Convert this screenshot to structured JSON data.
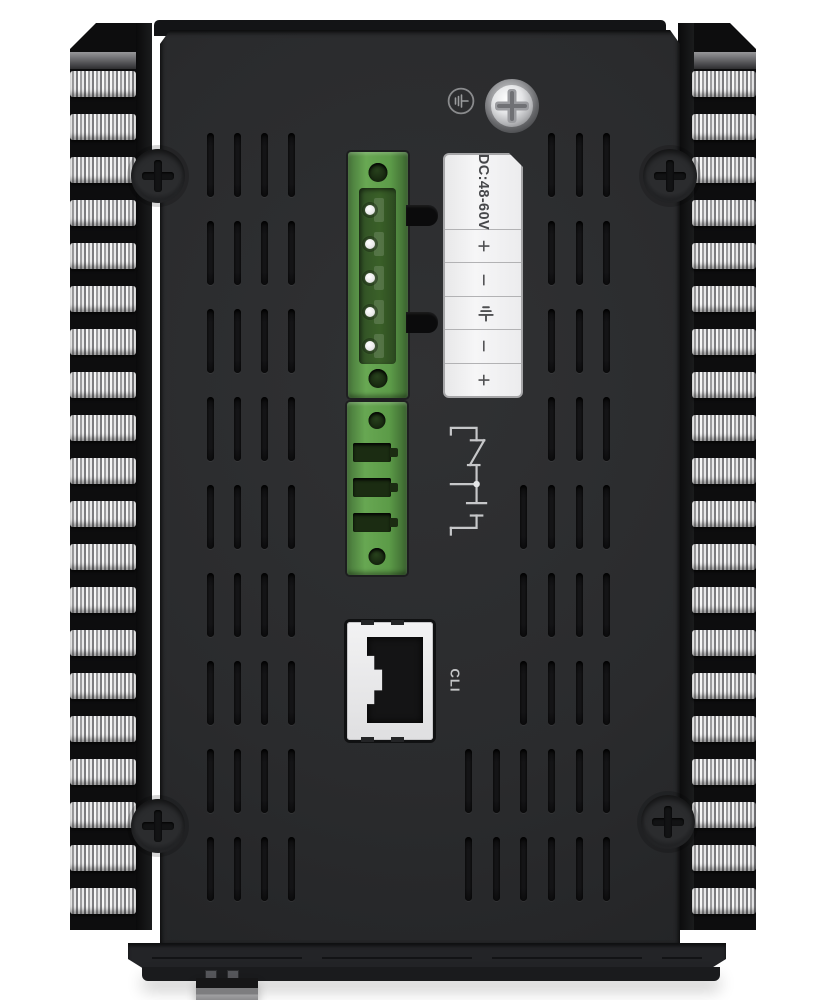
{
  "page": {
    "background": "#ffffff"
  },
  "device": {
    "description": "Industrial switch top panel with side heatsink fins",
    "body_color": "#2a2b2d",
    "connector_green": "#5d9c49",
    "label_white": "#f3f3f4"
  },
  "grounding": {
    "symbol_icon": "earth-ground-icon",
    "screw": "chassis-ground-screw"
  },
  "power_label": {
    "title": "DC:48-60V",
    "terminals": [
      {
        "type": "text",
        "value": "+"
      },
      {
        "type": "text",
        "value": "−"
      },
      {
        "type": "icon",
        "name": "earth-ground-icon"
      },
      {
        "type": "text",
        "value": "−"
      },
      {
        "type": "text",
        "value": "+"
      }
    ]
  },
  "power_connector": {
    "pins": 5,
    "side_tabs": 2
  },
  "relay_connector": {
    "slots": 3,
    "diagram": "alarm-relay-nc-com-no-contacts"
  },
  "console_port": {
    "label": "CLI",
    "type": "rj45"
  },
  "screws": {
    "corner_count": 4
  },
  "decor": {
    "fin_bands_per_side": 20,
    "vent_groups": [
      {
        "cols": [
          46.5,
          73.5,
          100.5,
          127.5
        ],
        "rows": [
          103,
          191,
          279,
          367,
          455,
          543,
          631,
          719,
          807
        ]
      },
      {
        "cols": [
          387.5,
          415.5,
          442.5
        ],
        "rows": [
          103,
          191,
          279,
          367
        ]
      },
      {
        "cols": [
          359.5,
          387.5,
          415.5,
          442.5
        ],
        "rows": [
          455,
          543,
          631
        ]
      },
      {
        "cols": [
          304.5,
          332.5,
          359.5,
          387.5,
          415.5,
          442.5
        ],
        "rows": [
          719,
          807
        ]
      }
    ],
    "power_pins_layout": {
      "x": 17,
      "first_y": 53,
      "step": 34
    },
    "relay_slots_layout": {
      "first_y": 41,
      "step": 35
    }
  }
}
